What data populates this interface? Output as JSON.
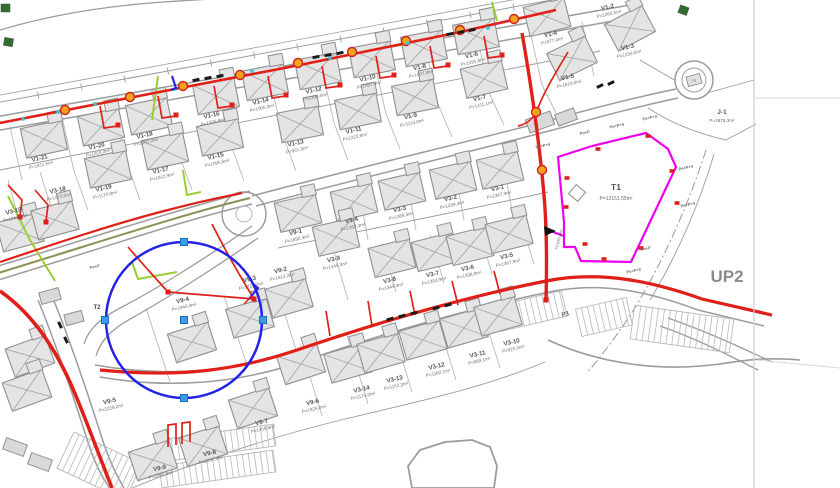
{
  "title": "site-plan",
  "colors": {
    "road": "#9b9b9b",
    "parcel": "#b8b8b8",
    "faint": "#d8d8d8",
    "red": "#e02018",
    "magenta": "#ee00ee",
    "blue": "#2323e8",
    "grip_fill": "#3d9be9",
    "grip_edge": "#1a6fb5",
    "orange": "#f5a31a",
    "cyan": "#35c8d8",
    "lime": "#9acd32",
    "olive": "#8e8e55",
    "darkgreen": "#2e6f2e",
    "house_fill": "#e4e4e4",
    "house_edge": "#8f8f8f",
    "label": "#565656",
    "area": "#6e6e6e",
    "black": "#1a1a1a"
  },
  "plots": [
    {
      "id": "V1-21",
      "area": "P=1811,5m²",
      "x": 40,
      "y": 160
    },
    {
      "id": "V1-20",
      "area": "P=1019,0m²",
      "x": 97,
      "y": 148
    },
    {
      "id": "V1-18",
      "area": "P=1007,2m²",
      "x": 145,
      "y": 137
    },
    {
      "id": "V1-16",
      "area": "P=1026,9m²",
      "x": 212,
      "y": 117
    },
    {
      "id": "V1-14",
      "area": "P=1005,3m²",
      "x": 261,
      "y": 103
    },
    {
      "id": "V1-12",
      "area": "P=1396,5m²",
      "x": 314,
      "y": 92
    },
    {
      "id": "V1-10",
      "area": "P=1097,9m²",
      "x": 368,
      "y": 80
    },
    {
      "id": "V1-8",
      "area": "P=1007,3m²",
      "x": 420,
      "y": 69
    },
    {
      "id": "V1-6",
      "area": "P=1291,8m²",
      "x": 472,
      "y": 57
    },
    {
      "id": "V1-4",
      "area": "P=977,4m²",
      "x": 551,
      "y": 36
    },
    {
      "id": "V1-2",
      "area": "P=1062,5m²",
      "x": 608,
      "y": 9
    },
    {
      "id": "V1-19",
      "area": "P=1170,9m²",
      "x": 104,
      "y": 190
    },
    {
      "id": "V1-17",
      "area": "P=1012,9m²",
      "x": 161,
      "y": 172
    },
    {
      "id": "V1-15",
      "area": "P=1095,6m²",
      "x": 216,
      "y": 158
    },
    {
      "id": "V1-13",
      "area": "P=961,3m²",
      "x": 296,
      "y": 145
    },
    {
      "id": "V1-11",
      "area": "P=1223,8m²",
      "x": 354,
      "y": 132
    },
    {
      "id": "V1-9",
      "area": "P=1113,0m²",
      "x": 411,
      "y": 118
    },
    {
      "id": "V1-7",
      "area": "P=1411,1m²",
      "x": 480,
      "y": 100
    },
    {
      "id": "V1-5",
      "area": "P=1810,0m²",
      "x": 568,
      "y": 79
    },
    {
      "id": "V1-3",
      "area": "P=1236,5m²",
      "x": 628,
      "y": 49
    },
    {
      "id": "V3-19",
      "area": "P=1043,1m²",
      "x": 14,
      "y": 213
    },
    {
      "id": "V3-18",
      "area": "P=1070,5m²",
      "x": 58,
      "y": 192
    },
    {
      "id": "V9-1",
      "area": "P=1892,3m²",
      "x": 296,
      "y": 234
    },
    {
      "id": "V3-4",
      "area": "P=1263,3m²",
      "x": 352,
      "y": 222
    },
    {
      "id": "V3-3",
      "area": "P=1389,3m²",
      "x": 400,
      "y": 211
    },
    {
      "id": "V3-2",
      "area": "P=1239,3m²",
      "x": 451,
      "y": 200
    },
    {
      "id": "V3-1",
      "area": "P=1367,9m²",
      "x": 498,
      "y": 190
    },
    {
      "id": "V9-2",
      "area": "P=1612,2m²",
      "x": 281,
      "y": 272
    },
    {
      "id": "V3-9",
      "area": "P=1445,3m²",
      "x": 334,
      "y": 261
    },
    {
      "id": "V3-8",
      "area": "P=1349,3m²",
      "x": 390,
      "y": 282
    },
    {
      "id": "V3-7",
      "area": "P=1283,9m²",
      "x": 433,
      "y": 276
    },
    {
      "id": "V3-6",
      "area": "P=1338,9m²",
      "x": 468,
      "y": 270
    },
    {
      "id": "V3-5",
      "area": "P=1367,9m²",
      "x": 507,
      "y": 258
    },
    {
      "id": "V9-3",
      "area": "P=1722,2m²",
      "x": 250,
      "y": 281
    },
    {
      "id": "V9-4",
      "area": "P=1940,3m²",
      "x": 183,
      "y": 302
    },
    {
      "id": "V9-5",
      "area": "P=2228,2m²",
      "x": 110,
      "y": 403
    },
    {
      "id": "V9-6",
      "area": "P=1926,0m²",
      "x": 313,
      "y": 404
    },
    {
      "id": "V3-14",
      "area": "P=1174,0m²",
      "x": 362,
      "y": 391
    },
    {
      "id": "V3-13",
      "area": "P=1152,2m²",
      "x": 395,
      "y": 381
    },
    {
      "id": "V3-12",
      "area": "P=1182,1m²",
      "x": 437,
      "y": 368
    },
    {
      "id": "V3-11",
      "area": "P=969,1m²",
      "x": 478,
      "y": 356
    },
    {
      "id": "V3-10",
      "area": "P=915,0m²",
      "x": 512,
      "y": 344
    },
    {
      "id": "V9-7",
      "area": "P=1459,8m²",
      "x": 262,
      "y": 424
    },
    {
      "id": "V9-8",
      "area": "P=2030,4m²",
      "x": 210,
      "y": 455
    },
    {
      "id": "V9-9",
      "area": "P=2080,9m²",
      "x": 160,
      "y": 470
    }
  ],
  "special_labels": [
    {
      "t": "UP2",
      "x": 727,
      "y": 282,
      "s": 17,
      "b": 1,
      "c": "#8a8a8a",
      "rot": 0
    },
    {
      "t": "T1",
      "x": 616,
      "y": 190,
      "s": 8.5,
      "b": 1,
      "c": "#555555",
      "rot": 0
    },
    {
      "t": "P=12151,55m²",
      "x": 616,
      "y": 200,
      "s": 5,
      "b": 0,
      "c": "#666666",
      "rot": 0
    },
    {
      "t": "J-1",
      "x": 722,
      "y": 114,
      "s": 6.5,
      "b": 1,
      "c": "#555555",
      "rot": 0
    },
    {
      "t": "P=1876,3m²",
      "x": 722,
      "y": 122,
      "s": 4.6,
      "b": 0,
      "c": "#666666",
      "rot": 0
    },
    {
      "t": "P1",
      "x": 566,
      "y": 316,
      "s": 6.5,
      "b": 1,
      "c": "#666666",
      "rot": -14
    },
    {
      "t": "T2",
      "x": 97,
      "y": 309,
      "s": 6,
      "b": 1,
      "c": "#444444",
      "rot": 0
    },
    {
      "t": "TS 10/0,4 kV",
      "x": 560,
      "y": 240,
      "s": 3.6,
      "b": 0,
      "c": "#555555",
      "rot": -75
    },
    {
      "t": "TR",
      "x": 694,
      "y": 82,
      "s": 3.5,
      "b": 0,
      "c": "#777777",
      "rot": 0
    }
  ],
  "po_labels": [
    {
      "t": "Po+P+4",
      "x": 543,
      "y": 147
    },
    {
      "t": "Po+P",
      "x": 585,
      "y": 134
    },
    {
      "t": "Po+P+4",
      "x": 617,
      "y": 127
    },
    {
      "t": "Po+P+4",
      "x": 650,
      "y": 119
    },
    {
      "t": "Po+P+4",
      "x": 686,
      "y": 169
    },
    {
      "t": "Po+P+4",
      "x": 688,
      "y": 206
    },
    {
      "t": "Po+P",
      "x": 646,
      "y": 250
    },
    {
      "t": "Po+P+2",
      "x": 634,
      "y": 272
    },
    {
      "t": "Po+P",
      "x": 95,
      "y": 268
    }
  ],
  "blue_circle": {
    "cx": 184,
    "cy": 320,
    "r": 78,
    "grips": [
      [
        184,
        320
      ],
      [
        184,
        242
      ],
      [
        263,
        320
      ],
      [
        184,
        398
      ],
      [
        105,
        320
      ]
    ]
  },
  "magenta": {
    "polygon": "M558,157 L592,146 L646,133 L668,149 L676,167 L631,262 L581,261 L575,247 L564,247 L564,222 Z",
    "spur": "M550,231 L564,236",
    "marks": [
      [
        567,
        178
      ],
      [
        566,
        207
      ],
      [
        598,
        149
      ],
      [
        648,
        136
      ],
      [
        672,
        171
      ],
      [
        677,
        203
      ],
      [
        641,
        248
      ],
      [
        604,
        259
      ],
      [
        585,
        244
      ]
    ],
    "inner_square": {
      "x": 577,
      "y": 193,
      "s": 12,
      "rot": 40
    },
    "arrow": "544,226 556,231 545,236"
  },
  "roads": [
    {
      "d": "M-5,131 L636,17",
      "w": 1.5
    },
    {
      "d": "M-5,117 L630,5",
      "w": 1.5
    },
    {
      "d": "M-5,281 C100,249 180,221 252,204",
      "w": 1.5
    },
    {
      "d": "M-5,267 C100,235 180,209 250,191",
      "w": 1.5
    },
    {
      "d": "M252,196 C360,167 480,139 562,117 C612,103 652,94 676,89",
      "w": 1.5
    },
    {
      "d": "M256,206 C364,177 482,149 564,127 C612,113 650,104 678,98",
      "w": 1.5
    },
    {
      "d": "M95,365 C170,378 235,371 292,352 C380,322 470,297 546,281 C602,270 654,282 704,300 L772,316",
      "w": 1.5
    },
    {
      "d": "M100,377 C175,390 240,382 298,363 C384,333 472,308 549,292 C602,281 650,292 698,310 L764,326",
      "w": 1.5
    },
    {
      "d": "M52,296 C66,330 84,382 100,432 C108,458 116,475 124,488",
      "w": 1.5
    },
    {
      "d": "M38,300 C52,334 70,386 86,436 C94,462 102,478 110,488",
      "w": 1.5
    },
    {
      "d": "M252,226 C206,258 158,288 124,306 C100,318 88,330 84,344",
      "w": 1.3
    },
    {
      "d": "M258,238 C212,270 164,300 132,318 C110,330 100,342 96,356",
      "w": 1.3
    },
    {
      "d": "M660,326 C700,340 730,356 758,370",
      "w": 1.3
    },
    {
      "d": "M668,318 C708,332 742,348 772,362",
      "w": 1.3
    },
    {
      "d": "M548,340 C600,364 660,372 720,364 C746,360 764,357 800,360",
      "w": 1.6
    },
    {
      "d": "M0,30 C40,18 90,8 150,3 C200,-1 235,-2 258,-3",
      "w": 1.3
    },
    {
      "d": "M-5,171 L600,51",
      "w": 0.9
    },
    {
      "d": "M278,248 C400,223 500,203 548,192",
      "w": 0.9
    },
    {
      "d": "M132,488 C220,452 300,430 345,419 C420,401 480,389 545,362",
      "w": 0.9
    },
    {
      "d": "M-5,96 L598,-16",
      "w": 0.8
    },
    {
      "d": "M714,154 C700,202 678,254 650,300",
      "w": 0.9
    },
    {
      "d": "M640,60 L700,95",
      "w": 0.9
    },
    {
      "d": "M700,95 L754,80",
      "w": 0.9
    },
    {
      "d": "M648,108 C672,124 700,134 726,140",
      "w": 0.9
    },
    {
      "d": "M726,140 L756,124",
      "w": 0.9
    }
  ],
  "dashdot": [
    {
      "d": "M706,150 C690,200 666,256 636,306 C620,332 604,352 588,372",
      "w": 1,
      "da": "9 3 2 3"
    },
    {
      "d": "M415,468 L425,455 L447,448 L470,446 L485,452 L491,468 L489,488",
      "w": 1,
      "da": "8 3 2 3"
    }
  ],
  "blob": "M408,466 L420,450 L445,442 L472,440 L490,447 L497,466 L494,488 L412,488 Z",
  "dim": {
    "d": "M-5,103 L600,-9",
    "x1": -5,
    "y1": 103,
    "x2": 600,
    "y2": -9,
    "n": 14,
    "tick": 7
  },
  "parcel_segments": [
    [
      10,
      126,
      22,
      180
    ],
    [
      62,
      117,
      74,
      171
    ],
    [
      114,
      107,
      126,
      161
    ],
    [
      166,
      98,
      178,
      152
    ],
    [
      218,
      88,
      230,
      142
    ],
    [
      270,
      79,
      282,
      133
    ],
    [
      322,
      69,
      334,
      123
    ],
    [
      374,
      60,
      386,
      114
    ],
    [
      426,
      50,
      438,
      104
    ],
    [
      478,
      41,
      490,
      95
    ],
    [
      530,
      31,
      542,
      85
    ],
    [
      582,
      22,
      594,
      76
    ],
    [
      74,
      171,
      88,
      210
    ],
    [
      126,
      161,
      140,
      200
    ],
    [
      178,
      152,
      192,
      190
    ],
    [
      230,
      142,
      244,
      181
    ],
    [
      282,
      133,
      296,
      171
    ],
    [
      334,
      123,
      348,
      160
    ],
    [
      386,
      114,
      400,
      149
    ],
    [
      438,
      104,
      452,
      137
    ],
    [
      490,
      95,
      504,
      125
    ],
    [
      542,
      85,
      556,
      113
    ],
    [
      312,
      206,
      320,
      250
    ],
    [
      360,
      196,
      368,
      240
    ],
    [
      408,
      186,
      416,
      230
    ],
    [
      456,
      177,
      464,
      220
    ],
    [
      504,
      168,
      512,
      210
    ],
    [
      334,
      252,
      348,
      300
    ],
    [
      382,
      243,
      396,
      292
    ],
    [
      430,
      235,
      444,
      283
    ],
    [
      478,
      226,
      492,
      274
    ],
    [
      520,
      218,
      534,
      264
    ],
    [
      300,
      344,
      322,
      416
    ],
    [
      346,
      332,
      368,
      404
    ],
    [
      390,
      320,
      412,
      392
    ],
    [
      434,
      308,
      456,
      380
    ],
    [
      478,
      297,
      500,
      368
    ],
    [
      146,
      308,
      170,
      382
    ],
    [
      224,
      296,
      248,
      368
    ],
    [
      276,
      286,
      298,
      356
    ],
    [
      8,
      180,
      20,
      224
    ],
    [
      40,
      172,
      54,
      216
    ]
  ],
  "houses": [
    [
      44,
      139,
      -12
    ],
    [
      101,
      127,
      -12
    ],
    [
      149,
      116,
      -12
    ],
    [
      216,
      96,
      -11
    ],
    [
      265,
      82,
      -11
    ],
    [
      318,
      71,
      -11
    ],
    [
      372,
      59,
      -11
    ],
    [
      424,
      48,
      -11
    ],
    [
      476,
      36,
      -11
    ],
    [
      547,
      17,
      -14
    ],
    [
      630,
      28,
      -28
    ],
    [
      572,
      58,
      -26
    ],
    [
      108,
      169,
      -12
    ],
    [
      165,
      151,
      -12
    ],
    [
      220,
      137,
      -12
    ],
    [
      300,
      124,
      -11
    ],
    [
      358,
      111,
      -11
    ],
    [
      415,
      97,
      -11
    ],
    [
      484,
      79,
      -13
    ],
    [
      298,
      213,
      -13
    ],
    [
      354,
      202,
      -13
    ],
    [
      402,
      191,
      -13
    ],
    [
      453,
      180,
      -13
    ],
    [
      500,
      170,
      -13
    ],
    [
      336,
      237,
      -13
    ],
    [
      392,
      258,
      -14
    ],
    [
      435,
      252,
      -14
    ],
    [
      470,
      246,
      -14
    ],
    [
      509,
      234,
      -14
    ],
    [
      250,
      318,
      -16
    ],
    [
      192,
      342,
      -18
    ],
    [
      289,
      298,
      -16
    ],
    [
      348,
      363,
      -16
    ],
    [
      381,
      353,
      -16
    ],
    [
      423,
      340,
      -16
    ],
    [
      464,
      328,
      -16
    ],
    [
      498,
      316,
      -16
    ],
    [
      301,
      364,
      -18
    ],
    [
      253,
      408,
      -18
    ],
    [
      203,
      446,
      -18
    ],
    [
      153,
      460,
      -18
    ],
    [
      30,
      356,
      -20
    ],
    [
      27,
      390,
      -20
    ],
    [
      20,
      232,
      -15
    ],
    [
      55,
      220,
      -15
    ]
  ],
  "plain_buildings": [
    [
      540,
      122,
      -20,
      26,
      14
    ],
    [
      566,
      117,
      -20,
      20,
      12
    ],
    [
      15,
      447,
      20,
      22,
      12
    ],
    [
      40,
      462,
      20,
      22,
      12
    ],
    [
      50,
      296,
      -15,
      20,
      12
    ],
    [
      74,
      318,
      -15,
      18,
      11
    ]
  ],
  "green_squares": [
    [
      8,
      42,
      10
    ],
    [
      683,
      10,
      20
    ],
    [
      5,
      8,
      0
    ]
  ],
  "red_mains": [
    {
      "d": "M0,123 L180,88 L300,65 L460,32 L556,10",
      "w": 2.6
    },
    {
      "d": "M522,33 C532,90 540,150 544,195 C547,230 547,262 546,300",
      "w": 3.4
    },
    {
      "d": "M0,262 C60,242 120,222 168,210 C205,200 228,196 242,193",
      "w": 2.2
    },
    {
      "d": "M0,291 C30,312 55,345 76,396 C90,430 100,458 112,488",
      "w": 3.6
    },
    {
      "d": "M100,370 C180,378 236,370 294,351 C382,321 470,296 546,281 C602,270 654,282 702,299 L772,315",
      "w": 3.2
    }
  ],
  "red_branches": [
    "M100,106 L104,128 L118,126",
    "M158,96 L162,118 L176,116",
    "M214,86 L218,108 L232,106",
    "M268,76 L272,98 L286,96",
    "M322,66 L326,88 L340,86",
    "M376,56 L380,78 L394,76",
    "M430,46 L434,68 L448,66",
    "M484,36 L488,58 L502,56",
    "M128,247 C146,268 160,283 168,292",
    "M168,292 L254,299",
    "M212,224 C228,256 243,281 254,299",
    "M330,336 L326,311",
    "M372,326 L368,301",
    "M415,315 L410,291",
    "M458,305 L452,281",
    "M500,294 L494,271",
    "M168,447 L168,425 L176,424 L176,445",
    "M182,444 L182,423 L190,422 L190,442",
    "M8,185 L22,200 L20,216",
    "M35,190 L48,205 L46,221",
    "M568,52 C556,72 544,92 538,108 C534,118 528,124 518,126"
  ],
  "red_nodes": [
    [
      168,
      292
    ],
    [
      254,
      299
    ],
    [
      546,
      300
    ],
    [
      118,
      125
    ],
    [
      176,
      115
    ],
    [
      232,
      105
    ],
    [
      286,
      95
    ],
    [
      340,
      85
    ],
    [
      394,
      75
    ],
    [
      448,
      65
    ],
    [
      502,
      55
    ],
    [
      20,
      217
    ],
    [
      46,
      222
    ]
  ],
  "manholes": [
    [
      65,
      110
    ],
    [
      130,
      97
    ],
    [
      183,
      86
    ],
    [
      240,
      75
    ],
    [
      298,
      63
    ],
    [
      352,
      52
    ],
    [
      406,
      41
    ],
    [
      460,
      30
    ],
    [
      514,
      19
    ],
    [
      536,
      112
    ],
    [
      542,
      170
    ]
  ],
  "cyan_dots": [
    [
      95,
      104
    ],
    [
      175,
      89
    ],
    [
      252,
      71
    ],
    [
      330,
      58
    ],
    [
      408,
      43
    ],
    [
      488,
      28
    ],
    [
      23,
      119
    ],
    [
      58,
      112
    ]
  ],
  "car_ticks": [
    [
      196,
      80,
      -12
    ],
    [
      208,
      78,
      -12
    ],
    [
      220,
      76,
      -12
    ],
    [
      316,
      57,
      -11
    ],
    [
      328,
      55,
      -11
    ],
    [
      340,
      53,
      -11
    ],
    [
      450,
      34,
      -11
    ],
    [
      461,
      32,
      -11
    ],
    [
      472,
      30,
      -11
    ],
    [
      390,
      319,
      -15
    ],
    [
      402,
      316,
      -15
    ],
    [
      414,
      313,
      -15
    ],
    [
      436,
      308,
      -15
    ],
    [
      448,
      305,
      -15
    ],
    [
      600,
      86,
      -25
    ],
    [
      611,
      83,
      -25
    ],
    [
      60,
      325,
      65
    ],
    [
      66,
      340,
      65
    ]
  ],
  "lime_lines": [
    "M158,76 L152,120",
    "M183,170 L187,195 L201,192",
    "M132,262 L138,279 L177,272",
    "M492,2 L497,21",
    "M8,196 L30,240 L55,281"
  ],
  "olive_line": "M-5,274 C100,242 180,215 250,198",
  "parking_strips": [
    {
      "x": 160,
      "y": 432,
      "w": 115,
      "h": 22,
      "rot": -8,
      "step": 6
    },
    {
      "x": 160,
      "y": 458,
      "w": 115,
      "h": 22,
      "rot": -8,
      "step": 6
    },
    {
      "x": 62,
      "y": 446,
      "w": 75,
      "h": 40,
      "rot": 25,
      "step": 6
    },
    {
      "x": 497,
      "y": 298,
      "w": 68,
      "h": 26,
      "rot": -13,
      "step": 6
    },
    {
      "x": 578,
      "y": 303,
      "w": 52,
      "h": 28,
      "rot": -13,
      "step": 6
    },
    {
      "x": 632,
      "y": 312,
      "w": 100,
      "h": 34,
      "rot": 8,
      "step": 6
    }
  ],
  "loop_circle": {
    "cx": 244,
    "cy": 214,
    "r1": 22,
    "r2": 8
  },
  "roundabout": {
    "cx": 694,
    "cy": 80,
    "r1": 19,
    "r2": 12,
    "rect": [
      687,
      75,
      14,
      10,
      -15
    ]
  },
  "north_arrow": {
    "blue": "M248,300 L258,288 L252,283",
    "red": "M244,304 L252,296"
  },
  "blue_tick": "M172,76 L176,88 L171,90",
  "sheet_edge_x": 754,
  "faint_lines": [
    {
      "d": "M755,98 L840,98"
    },
    {
      "d": "M757,360 L840,368"
    }
  ]
}
